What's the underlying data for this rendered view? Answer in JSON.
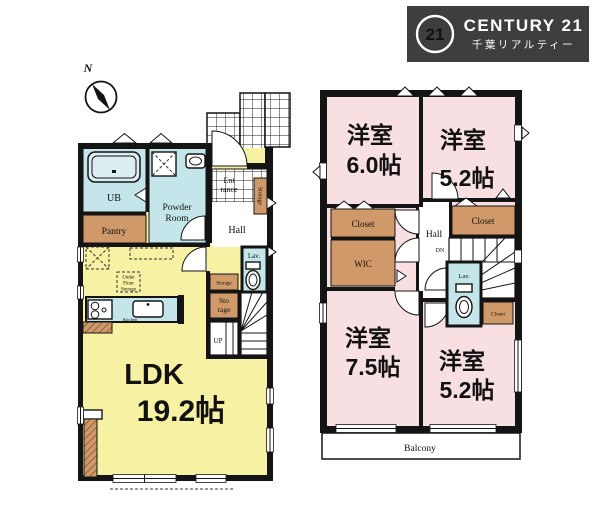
{
  "colors": {
    "wall": "#141414",
    "yellow": "#f6f1a3",
    "pink": "#f8dfe1",
    "blue": "#c4e5e9",
    "brown": "#d0996a",
    "logo-bg": "#3e3e40",
    "logo-fg": "#ffffff",
    "paper": "#ffffff"
  },
  "logo": {
    "seal": "21",
    "brand": "CENTURY 21",
    "subtitle": "千葉リアルティー"
  },
  "compass": {
    "north": "N"
  },
  "floor1": {
    "ub": "UB",
    "powder1": "Powder",
    "powder2": "Room",
    "pantry": "Pantry",
    "entrance1": "Ent",
    "entrance2": "rance",
    "hall": "Hall",
    "storage_side": "Storage",
    "lav": "Lav.",
    "storage_strip": "Storage",
    "storage_room1": "Sto",
    "storage_room2": "rage",
    "up": "UP",
    "underfloor1": "Under",
    "underfloor2": "Floor",
    "underfloor3": "Storage",
    "kitchen": "Kitchen",
    "ldk1": "LDK",
    "ldk2": "19.2帖"
  },
  "floor2": {
    "room_nw1": "洋室",
    "room_nw2": "6.0帖",
    "room_ne1": "洋室",
    "room_ne2": "5.2帖",
    "closet_l": "Closet",
    "wic": "WIC",
    "hall": "Hall",
    "dn": "DN",
    "closet_r": "Closet",
    "lav": "Lav.",
    "closet_s": "Closet",
    "room_sw1": "洋室",
    "room_sw2": "7.5帖",
    "room_se1": "洋室",
    "room_se2": "5.2帖",
    "balcony": "Balcony"
  }
}
